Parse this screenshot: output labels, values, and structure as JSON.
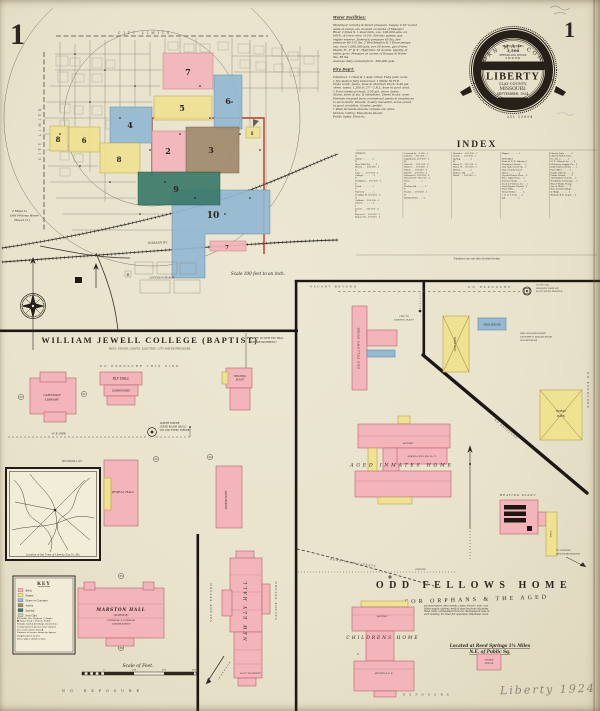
{
  "page": {
    "sheet_number_left": "1",
    "sheet_number_right": "1",
    "plate_number": "351 13894",
    "pencil_note": "Liberty  1924"
  },
  "seal": {
    "company": "SANBORN MAP COMPANY",
    "population_label": "POPULATION",
    "population": "3,500",
    "winds_label": "PREVAILING WINDS",
    "winds": "S.W. & N.W.",
    "report_line1": "FOR WATER FACILITIES AND FIRE",
    "report_line2": "DEPARTMENT SEE REPORT",
    "city": "LIBERTY",
    "county": "CLAY COUNTY,",
    "state": "MISSOURI.",
    "date": "SEPTEMBER, 1924.",
    "office": "NEW YORK"
  },
  "notes": {
    "water_title": "Water Facilities:",
    "water_body": "Municipal. Gravity & direct pressure. Supply 2-10\" bored\nwells at pump. sta. located on banks of Missouri\nRiver 2 miles S. 1 steel tank, cap. 100,000 gals. on\nhill N. of town: elev. 110 ft. Electric pumps, gas\nengine reserve. Domestic pressure 45 lbs: fire\npressure 60-115 lbs. 2 Worthington & 1 Dean pumps,\ncap. each 1,000,000 gals. per 24 hours, gas driven.\nMains: 8\", 6\" & 4\". Hydrants: 52 double. Quality of\nwater good. Pressure at corner of Kansas & Water\nSts. 38 lbs.\nAverage daily consumption : 300,000 gals.",
    "fire_title": "Fire Dep't:",
    "fire_body": "Volunteer. 1 Chief & 1 Asst. Chief. Fully paid: none.\n1 fire station fully motorized. 1 White 50 H.P.\ntriple comb. pump, hose & chemical truck: 2-40 gal.\nchem. tanks: 1,200 ft. 2½\" C.R.L. hose in good cond.\n1 Ford chemical truck: 2-30 gal. chem. tanks.\nAlarm: siren at sta. & telephone. Street boxes: none.\nFiremen respond from commercial plants & residences\nto each alarm. Streets: mostly macadam, some paved,\nin good condition. Grades: gentle.\n1 Wide Grounds streets; oblique are oiled.\nGrades: rolling. Elevations shown.\nPublic lights: Electric."
  },
  "index": {
    "title": "INDEX",
    "footnote": "Numbers run one side of street fronts.",
    "columns": [
      "STREETS\nA\nArthur . . . . . . . 3\nB\nBlue Mills Rd . . . . 6\nBrown . . . 200-299 . 3\nC\nClay . . . . 101-199 . 2\nCollege . . . . . . . 4\nD\nDoniphan . . 201-299 . 3\nE\nEsteb . . . . . . . . 5\nF\nFairview . . . . . . 5\nFranklin W. 101-216 . 2\nG\nGallatin . . 101-299 . 2\nGrover . . . . . . . 3\nJ\nJewell . . . 201-299 . 4\nK\nKansas E. . 101-316 . 2\nKansas W. . 101-216 . 2",
      "Leonard Av . 1-160 . 6\nLiberty . . 201-260 . 5\nLightburne  201-299 . 3\nM\nMain N. . . 101-316 . 2\nMain S. . . 101-260 . 3\nMill E. . . 101-260 . 2\nMill W. . . 101-216 . 2\nMissouri E. 101-299 . 4\nMissouri W. 101-216 . 4\nMoss . . . . . . . . 5\nN\nNashua Rd . . . . . . 6\nP\nPrairie . . 201-260 . 4\nR\nRichfield Rd . . . . 6",
      "Shrader . . 101-199 . 5\nSouth . . . 201-299 . 5\nSpring . . . . . . . 4\nW\nWater E. . 101-316 . 2\nWater W. . 101-216 . 2\nWilson . . . . . . . 6\nWithers Rd . . . . . 6\nWood . . . 201-260 . 5",
      "Wigan . . . . . . . 5\n\nSPECIALS\nBank of N. B. Liberty  2\nChristian Church . . . 2\nCity Hall, Court Sq. . 2\nClay County Court\n  House . . . . . . . 2\nCrystal Palace Thea. . 2\nElec. Light Plant . . 3\nFarmers Bank . . . . . 2\nFeed & Produce Co. . . 2\nFirst Baptist Church . 2\nFlour Mill . . . . . . 3\nHotel Arthur . . . . . 2\nI. O. O. F. Hall . . . 2\nJail . . . . . . . . . 2",
      "Liberty Ldry . . . . . 3\nLiberty Mill & Elev.\n  Co. No. 2 . . . . . 3\nM. E. Church So. . . . 2\nM'chinery Supply Co. . 2\nOdd Fellows Home . . . 1\nPost Office . . . . . 2\nPublic Library . . . . 2\nPublic School . . . . 3\n2nd Baptist Church . . 3\nTelephone Exchange . . 2\nWater Works Pump.\n  Sta. & Wells . . . . 6\nWm. Jewell College\n  & Bldgs. . . . . . . 1\nWabash R.R. Depot . . 3"
    ]
  },
  "map": {
    "city_limits": "CITY LIMITS",
    "scale_note": "Scale 100 feet to an inch.",
    "ref1": "2 Miles to",
    "ref2": "Odd Fellows Home",
    "ref3": "(Sheet 11)",
    "lincoln_place": "LINCOLN PLACE",
    "r_label": "R",
    "rail1": "H. & ST. JO. R.R.",
    "rail2": "WABASH RY.",
    "blocks": {
      "b1": "1",
      "b2": "2",
      "b3": "3",
      "b4": "4",
      "b5": "5",
      "b6": "6",
      "b6b": "6",
      "b7": "7",
      "b7b": "7",
      "b8": "8",
      "b8b": "8",
      "b9": "9",
      "b10": "10"
    }
  },
  "college": {
    "title": "WILLIAM JEWELL COLLEGE (BAPTIST)",
    "subtitle": "HEAT: STEAM.  LIGHTS: ELECTRIC.  CITY WATER PRESSURE.",
    "no_exposure_side": "NO EXPOSURE THIS SIDE",
    "no_exposure": "NO EXPOSURE",
    "detach1": "150 FT. TO NEW ELY HALL",
    "detach2": "(SEE DETACHMENT)",
    "windmill_st": "WINDMILL ST.",
    "water_tower1": "WATER TOWER",
    "water_tower2": "(TANK 40,000 GALS.)",
    "water_tower3": "ON 100' STEEL TOWER",
    "pipe_label": "4\" B. PIPE",
    "carnegie1": "CARNEGIE",
    "carnegie2": "LIBRARY",
    "ely": "ELY HALL",
    "ely_sub": "DORMITORIES",
    "heating1": "HEATING",
    "heating2": "PLANT",
    "jewell": "JEWELL HALL",
    "dorm": "DORMITORY",
    "marston": "MARSTON HALL",
    "marston_sub": "(SCIENCE)",
    "marston_d1": "CHEMICAL & PHYSICAL",
    "marston_d2": "LABORATORIES",
    "newely": "NEW ELY HALL",
    "vacant": "VACANT BEYOND",
    "street_note": "60 FT. TO STREET",
    "circled": [
      "27",
      "21",
      "25",
      "24",
      "35",
      "36"
    ]
  },
  "odd_fellows": {
    "vacant": "VACANT BEYOND",
    "no_exposure": "NO EXPOSURE",
    "exposure": "EXPOSURE",
    "tank1": "50,000 GAL.",
    "tank2": "WOODEN TANK ON",
    "tank3": "80 FT. STEEL TRESTLE",
    "pipe1": "PIPE TO",
    "pipe2": "HEATING PLANT",
    "home_vert": "ODD FELLOWS HOME",
    "cow_barn": "COW BARN",
    "milk_house": "MILK HOUSE",
    "laundry1": "ODD FELLOWS HOME",
    "laundry2": "LAUNDRY & BOILER ROOM",
    "laundry3": "NO EXPOSURE",
    "horse1": "HORSE",
    "horse2": "BARN",
    "aged": "AGED INMATES HOME",
    "aged_d1": "LAUNDRY",
    "aged_d2": "BOILER & ENG. RM. No. 72",
    "heating_plant": "HEATING PLANT",
    "shed": "SHED",
    "cistern1": "TO CISTERN",
    "cistern2": "(SEE DETACHMENT)",
    "cistern_line": "CISTERN",
    "road": "ROAD FROM LIBERTY",
    "title": "ODD FELLOWS HOME",
    "subtitle": "FOR ORPHANS & THE AGED",
    "desc": "By subscription. Heat: steam. Lights: electric. Fuel: coal.\nWater supply: cisterns, wells & pipe line from city mains.\nHand chem. extinguishers thru'out. Standpipes & hose in\neach building. No other fire apparatus. Watchman: none.",
    "located1": "Located at Reed Springs 1¾ Miles",
    "located2": "N.E. of Public Sq.",
    "childrens": "CHILDRENS HOME",
    "child_c": "C",
    "child_d1": "LAUNDRY",
    "child_d2": "KITCHEN & D. R.",
    "smoke1": "SMOKE",
    "smoke2": "HOUSE"
  },
  "key": {
    "title": "KEY",
    "swatches": [
      {
        "color": "#f3b4ba",
        "label": "Brick"
      },
      {
        "color": "#efe291",
        "label": "Frame"
      },
      {
        "color": "#93b9d3",
        "label": "Stone or Concrete"
      },
      {
        "color": "#a18a6d",
        "label": "Adobe"
      },
      {
        "color": "#3c7a68",
        "label": "Special"
      },
      {
        "color": "#c9c9bf",
        "label": "Iron Clad"
      }
    ],
    "lines": "✚ Double Fire Hydrant   ○ Single\n● Water Tank    ✕ Private Stable\nShingle roofed dwellings shown thus\nComposition & gravel roofs shaded\nFire walls shown thus ▮\nNumber of stories shown by figures\nHeights given in feet\nWater pipes shown in blue"
  },
  "inset": {
    "caption": "Location of the Town of Liberty   Clay Co. Mo."
  },
  "scale_bar": {
    "label": "Scale of Feet.",
    "ticks": [
      "0",
      "100",
      "200",
      "300"
    ]
  },
  "colors": {
    "brick_pink": "#f3b4ba",
    "frame_yellow": "#efe291",
    "stone_blue": "#93b9d3",
    "adobe_brown": "#a18a6d",
    "special_green": "#3c7a68",
    "boundary_red": "#b23a2c",
    "ink": "#2e2720"
  }
}
